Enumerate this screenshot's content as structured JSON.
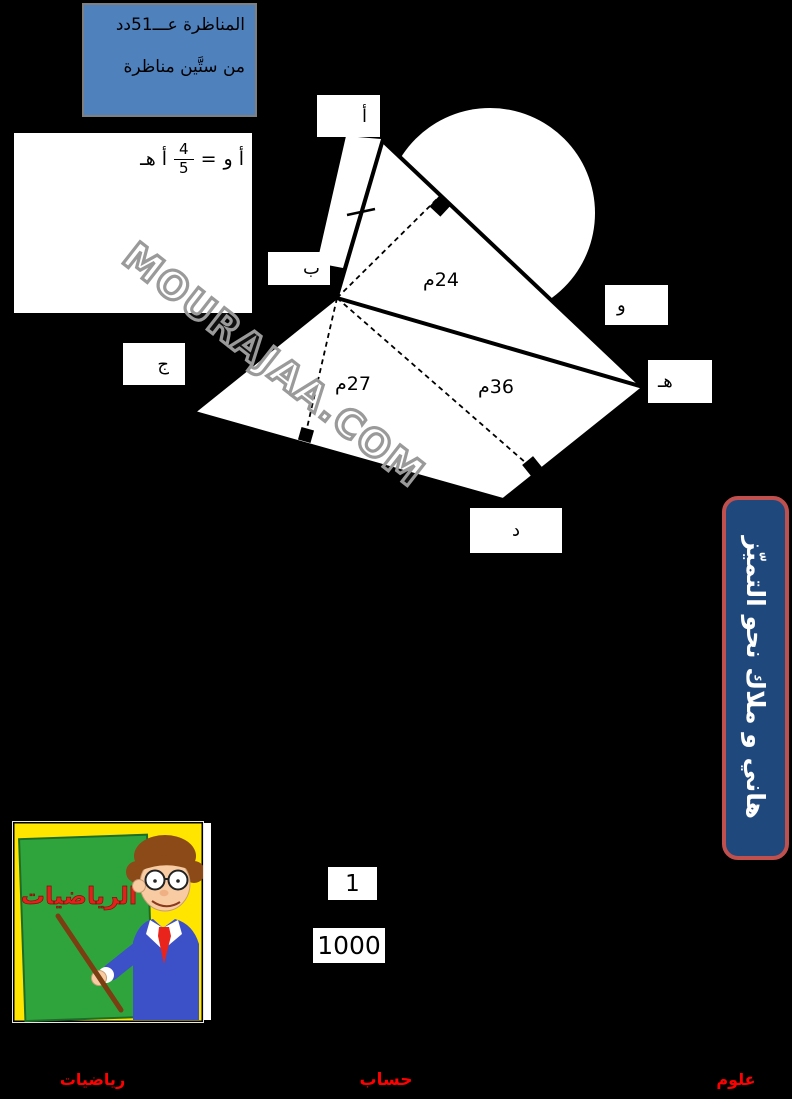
{
  "top_box": {
    "line1": "المناظرة عـــ51دد",
    "line2": "من ستَّين مناظرة",
    "fill_color": "#4F81BD"
  },
  "equation": {
    "lhs": "أ و",
    "equals": "=",
    "numerator": "4",
    "denominator": "5",
    "rhs": "أ هـ"
  },
  "figure": {
    "labels": {
      "a": "أ",
      "b": "ب",
      "j": "ج",
      "d": "د",
      "h": "هـ",
      "w": "و"
    },
    "measurements": {
      "m24": "24م",
      "m27": "27م",
      "m36": "36م"
    }
  },
  "watermark": {
    "text": "MOURAJAA.COM"
  },
  "banner": {
    "text": "هاني و ملاك نحو التميّز",
    "fill_color": "#1F497D",
    "border_color": "#C0504D"
  },
  "scale_boxes": {
    "numerator": "1",
    "denominator": "1000"
  },
  "cartoon": {
    "board_text": "الرياضيات"
  },
  "footer": {
    "left": "رياضيات",
    "center": "حساب",
    "right": "علوم",
    "color": "#FF0000"
  }
}
